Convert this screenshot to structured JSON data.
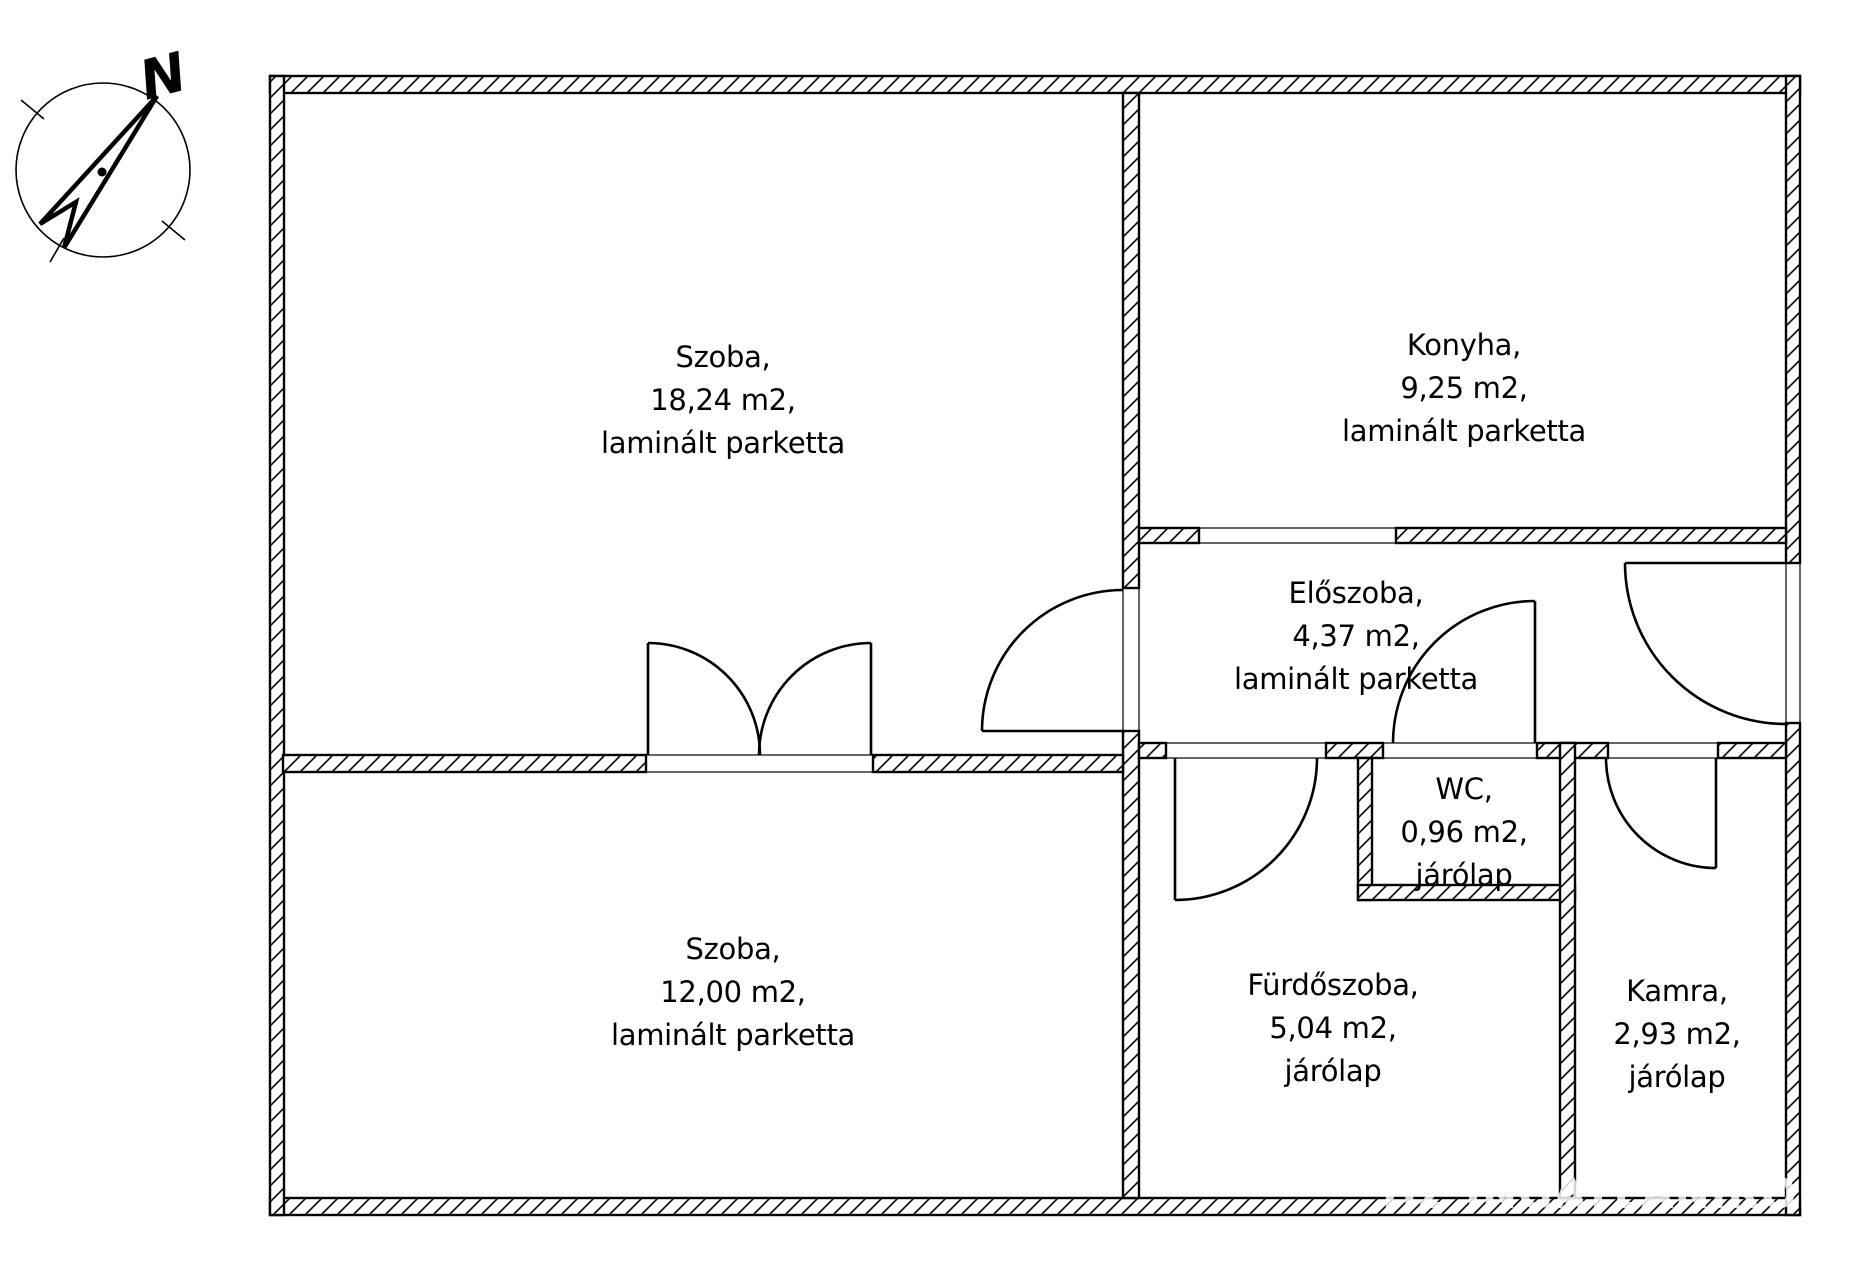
{
  "compass": {
    "label": "N"
  },
  "rooms": [
    {
      "name": "Szoba,",
      "area": "18,24 m2,",
      "floor": "laminált parketta"
    },
    {
      "name": "Konyha,",
      "area": "9,25 m2,",
      "floor": "laminált parketta"
    },
    {
      "name": "Előszoba,",
      "area": "4,37 m2,",
      "floor": "laminált parketta"
    },
    {
      "name": "WC,",
      "area": "0,96 m2,",
      "floor": "járólap"
    },
    {
      "name": "Szoba,",
      "area": "12,00 m2,",
      "floor": "laminált parketta"
    },
    {
      "name": "Fürdőszoba,",
      "area": "5,04 m2,",
      "floor": "járólap"
    },
    {
      "name": "Kamra,",
      "area": "2,93 m2,",
      "floor": "járólap"
    }
  ],
  "watermark": {
    "text": "HZ INGATLANIRODA"
  },
  "colors": {
    "line": "#000000",
    "background": "#ffffff",
    "watermark": "#d4d4d4"
  }
}
